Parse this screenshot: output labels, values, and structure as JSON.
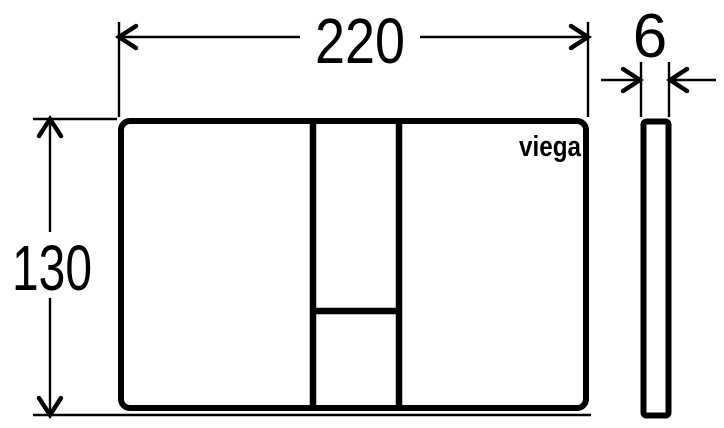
{
  "drawing": {
    "type": "technical-dimension-drawing",
    "brand_logo": "viega",
    "dimensions": {
      "width": "220",
      "height": "130",
      "thickness": "6"
    },
    "colors": {
      "line": "#000000",
      "background": "#ffffff"
    }
  }
}
